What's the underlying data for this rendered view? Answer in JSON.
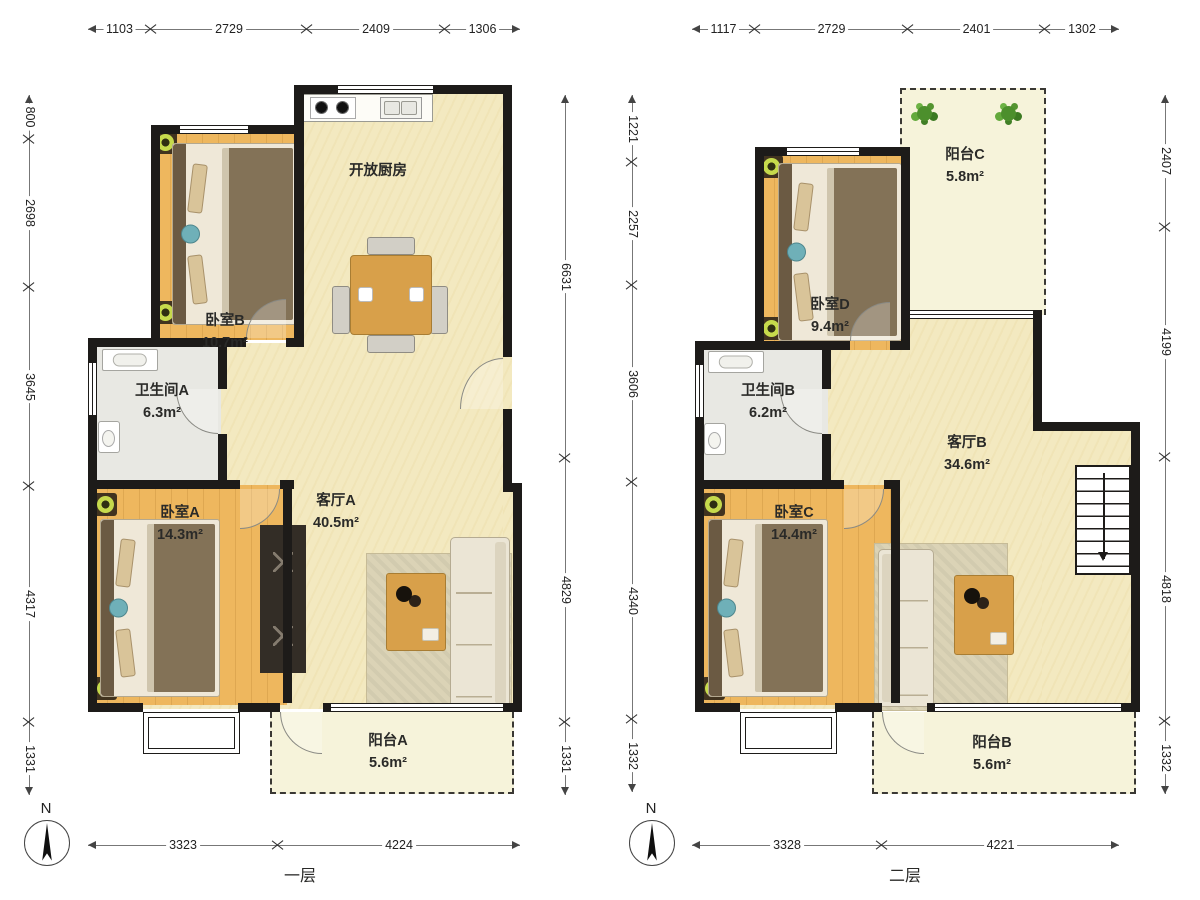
{
  "page": {
    "north": "N"
  },
  "colors": {
    "wall": "#1d1b19",
    "bedfloor": "#eeb75e",
    "livefloor": "#f3e9c0",
    "balcfloor": "#f6f3da",
    "bathfloor": "#e8e8e3",
    "wood": "#d8a04a",
    "ink": "#2a2a28"
  },
  "floor1": {
    "caption": "一层",
    "dims": {
      "top": [
        "1103",
        "2729",
        "2409",
        "1306"
      ],
      "left": [
        "800",
        "2698",
        "3645",
        "4317",
        "1331"
      ],
      "right": [
        "6631",
        "4829",
        "1331"
      ],
      "bottom": [
        "3323",
        "4224"
      ]
    },
    "rooms": {
      "kitchen": {
        "label": "开放厨房",
        "area": ""
      },
      "bedroomB": {
        "label": "卧室B",
        "area": "10.7m²"
      },
      "bathroomA": {
        "label": "卫生间A",
        "area": "6.3m²"
      },
      "bedroomA": {
        "label": "卧室A",
        "area": "14.3m²"
      },
      "livingA": {
        "label": "客厅A",
        "area": "40.5m²"
      },
      "balconyA": {
        "label": "阳台A",
        "area": "5.6m²"
      }
    }
  },
  "floor2": {
    "caption": "二层",
    "dims": {
      "top": [
        "1117",
        "2729",
        "2401",
        "1302"
      ],
      "left": [
        "1221",
        "2257",
        "3606",
        "4340",
        "1332"
      ],
      "right": [
        "2407",
        "4199",
        "4818",
        "1332"
      ],
      "bottom": [
        "3328",
        "4221"
      ]
    },
    "rooms": {
      "balconyC": {
        "label": "阳台C",
        "area": "5.8m²"
      },
      "bedroomD": {
        "label": "卧室D",
        "area": "9.4m²"
      },
      "bathroomB": {
        "label": "卫生间B",
        "area": "6.2m²"
      },
      "bedroomC": {
        "label": "卧室C",
        "area": "14.4m²"
      },
      "livingB": {
        "label": "客厅B",
        "area": "34.6m²"
      },
      "balconyB": {
        "label": "阳台B",
        "area": "5.6m²"
      }
    }
  }
}
